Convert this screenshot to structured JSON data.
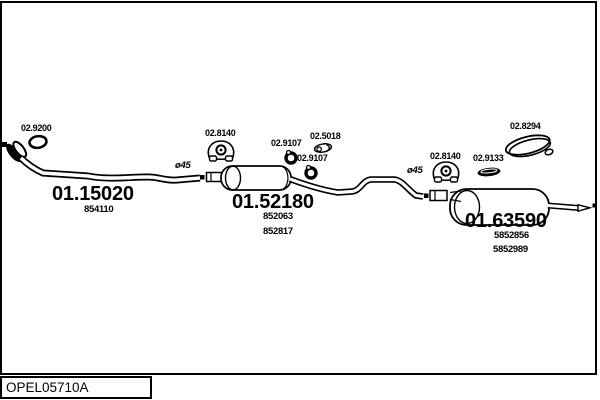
{
  "footer": {
    "catalog_code": "OPEL05710A"
  },
  "colors": {
    "line": "#000000",
    "background": "#ffffff"
  },
  "parts": {
    "front_gasket": {
      "ref": "02.9200",
      "icon": "gasket-ring-icon"
    },
    "front_pipe": {
      "ref": "01.15020",
      "oe": [
        "854110"
      ],
      "diameter": "ø45"
    },
    "hanger_mid": {
      "ref": "02.8140",
      "icon": "rubber-hanger-icon"
    },
    "seal_ring_upper": {
      "ref": "02.9107",
      "icon": "seal-ring-icon"
    },
    "clamp_mid": {
      "ref": "02.5018",
      "icon": "pipe-clamp-icon"
    },
    "seal_ring_lower": {
      "ref": "02.9107",
      "icon": "seal-ring-icon"
    },
    "mid_silencer": {
      "ref": "01.52180",
      "oe": [
        "852063",
        "852817"
      ]
    },
    "rear_pipe": {
      "diameter": "ø45"
    },
    "hanger_rear": {
      "ref": "02.8140",
      "icon": "rubber-hanger-icon"
    },
    "clamp_rear": {
      "ref": "02.9133",
      "icon": "band-clamp-icon"
    },
    "tail_trim_ring": {
      "ref": "02.8294",
      "icon": "tailpipe-trim-ring-icon"
    },
    "rear_silencer": {
      "ref": "01.63590",
      "oe": [
        "5852856",
        "5852989"
      ]
    }
  }
}
